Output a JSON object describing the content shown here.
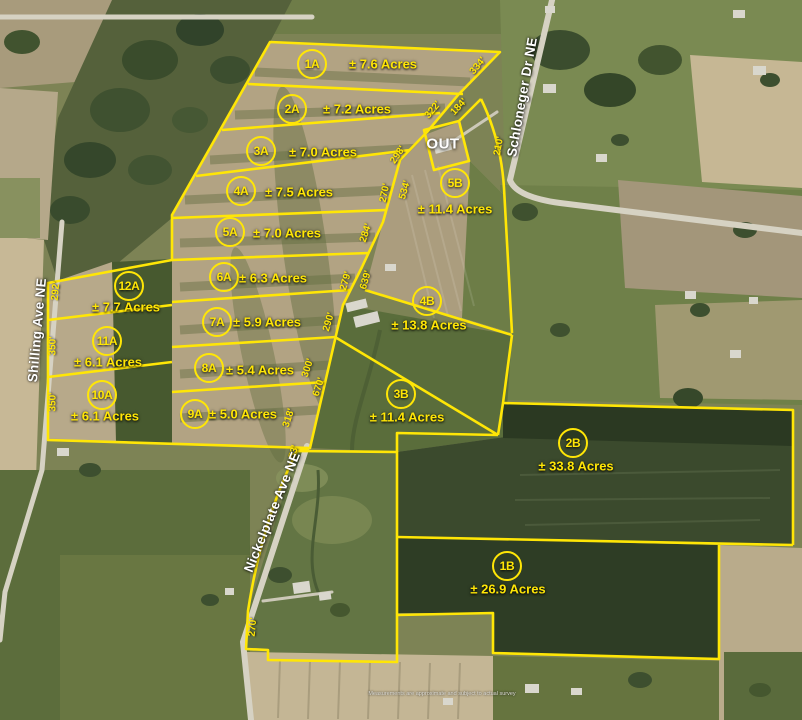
{
  "map": {
    "out": {
      "label": "OUT"
    },
    "disclaimer": "Measurements are approximate and subject to actual survey",
    "accent_color": "#ffe606",
    "road_label_color": "#ffffff",
    "roads": [
      {
        "name": "Schloneger Dr NE",
        "x": 522,
        "y": 97,
        "rotate": -80
      },
      {
        "name": "Shilling Ave NE",
        "x": 37,
        "y": 330,
        "rotate": -85
      },
      {
        "name": "Nickelplate Ave NE",
        "x": 272,
        "y": 512,
        "rotate": -68
      }
    ],
    "parcels": [
      {
        "id": "1A",
        "acres": "± 7.6 Acres",
        "cx": 312,
        "cy": 64,
        "tx": 383,
        "ty": 64
      },
      {
        "id": "2A",
        "acres": "± 7.2 Acres",
        "cx": 292,
        "cy": 109,
        "tx": 357,
        "ty": 109
      },
      {
        "id": "3A",
        "acres": "± 7.0 Acres",
        "cx": 261,
        "cy": 151,
        "tx": 323,
        "ty": 152
      },
      {
        "id": "4A",
        "acres": "± 7.5 Acres",
        "cx": 241,
        "cy": 191,
        "tx": 299,
        "ty": 192
      },
      {
        "id": "5A",
        "acres": "± 7.0 Acres",
        "cx": 230,
        "cy": 232,
        "tx": 287,
        "ty": 233
      },
      {
        "id": "6A",
        "acres": "± 6.3 Acres",
        "cx": 224,
        "cy": 277,
        "tx": 273,
        "ty": 278
      },
      {
        "id": "7A",
        "acres": "± 5.9 Acres",
        "cx": 217,
        "cy": 322,
        "tx": 267,
        "ty": 322
      },
      {
        "id": "8A",
        "acres": "± 5.4 Acres",
        "cx": 209,
        "cy": 368,
        "tx": 260,
        "ty": 370
      },
      {
        "id": "9A",
        "acres": "± 5.0 Acres",
        "cx": 195,
        "cy": 414,
        "tx": 243,
        "ty": 414
      },
      {
        "id": "12A",
        "acres": "± 7.7 Acres",
        "cx": 129,
        "cy": 286,
        "tx": 126,
        "ty": 307
      },
      {
        "id": "11A",
        "acres": "± 6.1 Acres",
        "cx": 107,
        "cy": 341,
        "tx": 108,
        "ty": 362
      },
      {
        "id": "10A",
        "acres": "± 6.1 Acres",
        "cx": 102,
        "cy": 395,
        "tx": 105,
        "ty": 416
      },
      {
        "id": "5B",
        "acres": "± 11.4 Acres",
        "cx": 455,
        "cy": 183,
        "tx": 455,
        "ty": 209
      },
      {
        "id": "4B",
        "acres": "± 13.8 Acres",
        "cx": 427,
        "cy": 301,
        "tx": 429,
        "ty": 325
      },
      {
        "id": "3B",
        "acres": "± 11.4 Acres",
        "cx": 401,
        "cy": 394,
        "tx": 407,
        "ty": 417
      },
      {
        "id": "2B",
        "acres": "± 33.8 Acres",
        "cx": 573,
        "cy": 443,
        "tx": 576,
        "ty": 466
      },
      {
        "id": "1B",
        "acres": "± 26.9 Acres",
        "cx": 507,
        "cy": 566,
        "tx": 508,
        "ty": 589
      }
    ],
    "dimensions": [
      {
        "text": "334'",
        "x": 478,
        "y": 66,
        "rotate": -50
      },
      {
        "text": "322'",
        "x": 433,
        "y": 110,
        "rotate": -50
      },
      {
        "text": "184'",
        "x": 459,
        "y": 107,
        "rotate": -47
      },
      {
        "text": "210'",
        "x": 499,
        "y": 146,
        "rotate": -80
      },
      {
        "text": "298'",
        "x": 398,
        "y": 155,
        "rotate": -56
      },
      {
        "text": "270'",
        "x": 385,
        "y": 193,
        "rotate": -78
      },
      {
        "text": "534'",
        "x": 405,
        "y": 190,
        "rotate": -74
      },
      {
        "text": "284'",
        "x": 366,
        "y": 233,
        "rotate": -72
      },
      {
        "text": "279'",
        "x": 346,
        "y": 281,
        "rotate": -74
      },
      {
        "text": "639'",
        "x": 366,
        "y": 280,
        "rotate": -74
      },
      {
        "text": "290'",
        "x": 329,
        "y": 322,
        "rotate": -74
      },
      {
        "text": "300'",
        "x": 308,
        "y": 368,
        "rotate": -72
      },
      {
        "text": "670'",
        "x": 319,
        "y": 387,
        "rotate": -72
      },
      {
        "text": "318'",
        "x": 289,
        "y": 418,
        "rotate": -72
      },
      {
        "text": "53'",
        "x": 294,
        "y": 452,
        "rotate": -74
      },
      {
        "text": "292'",
        "x": 56,
        "y": 291,
        "rotate": -85
      },
      {
        "text": "350'",
        "x": 53,
        "y": 346,
        "rotate": -89
      },
      {
        "text": "350'",
        "x": 53,
        "y": 402,
        "rotate": -89
      },
      {
        "text": "270'",
        "x": 253,
        "y": 627,
        "rotate": -85
      }
    ]
  }
}
